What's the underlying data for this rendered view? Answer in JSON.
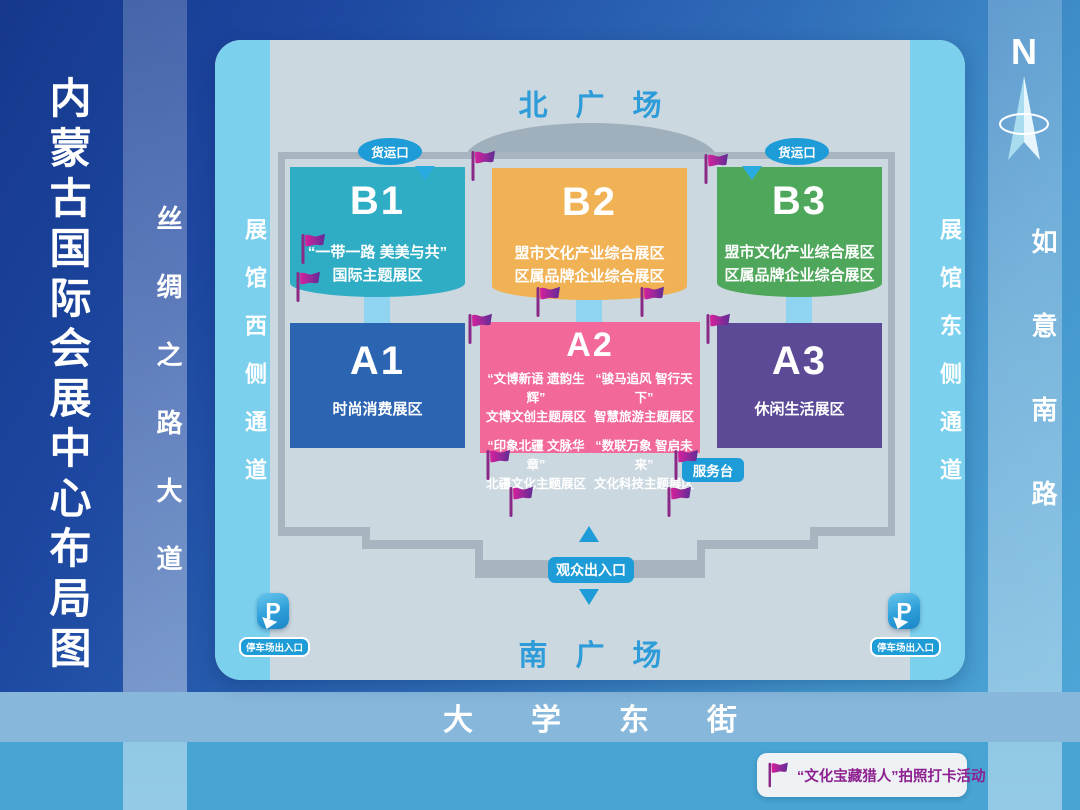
{
  "title": "内蒙古国际会展中心布局图",
  "compass": {
    "north_label": "N"
  },
  "roads": {
    "west_vertical": "丝绸之路大道",
    "east_vertical": "如意南路",
    "south_horizontal": "大学东街"
  },
  "map": {
    "plaza_north": "北广场",
    "plaza_south": "南广场",
    "passage_west": "展馆西侧通道",
    "passage_east": "展馆东侧通道",
    "badge_freight": "货运口",
    "badge_service": "服务台",
    "badge_visitor": "观众出入口",
    "badge_parking": "停车场出入口",
    "parking_letter": "P",
    "flag_positions": [
      [
        255,
        109
      ],
      [
        488,
        112
      ],
      [
        85,
        192
      ],
      [
        80,
        230
      ],
      [
        320,
        245
      ],
      [
        424,
        245
      ],
      [
        252,
        272
      ],
      [
        490,
        272
      ],
      [
        270,
        408
      ],
      [
        458,
        408
      ],
      [
        293,
        445
      ],
      [
        451,
        445
      ]
    ]
  },
  "halls": [
    {
      "id": "B1",
      "color": "#2fadc5",
      "lines": [
        "“一带一路 美美与共”",
        "国际主题展区"
      ]
    },
    {
      "id": "B2",
      "color": "#f0b254",
      "lines": [
        "盟市文化产业综合展区",
        "区属品牌企业综合展区"
      ]
    },
    {
      "id": "B3",
      "color": "#4fa75b",
      "lines": [
        "盟市文化产业综合展区",
        "区属品牌企业综合展区"
      ]
    },
    {
      "id": "A1",
      "color": "#2b64b1",
      "lines": [
        "时尚消费展区"
      ]
    },
    {
      "id": "A2",
      "color": "#f2689b",
      "quadrants": [
        {
          "q": "“文博新语 遗韵生辉”",
          "n": "文博文创主题展区"
        },
        {
          "q": "“骏马追风 智行天下”",
          "n": "智慧旅游主题展区"
        },
        {
          "q": "“印象北疆 文脉华章”",
          "n": "北疆文化主题展区"
        },
        {
          "q": "“数联万象 智启未来”",
          "n": "文化科技主题展区"
        }
      ]
    },
    {
      "id": "A3",
      "color": "#5c4a96",
      "lines": [
        "休闲生活展区"
      ]
    }
  ],
  "legend": {
    "text": "“文化宝藏猎人”拍照打卡活动"
  },
  "colors": {
    "flag_gradient_start": "#d6219c",
    "flag_gradient_end": "#5f2d96",
    "badge_cyan": "#1e9cd8",
    "plaza_text": "#2e9cd8",
    "legend_text": "#8e2190"
  }
}
